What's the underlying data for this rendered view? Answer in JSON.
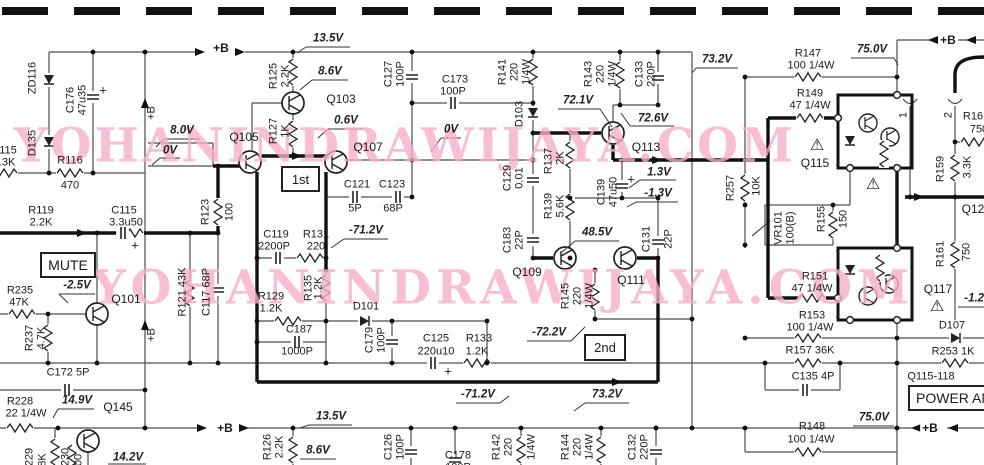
{
  "watermark": {
    "text": "YOHANINDRAWIJAYA.COM"
  },
  "boxes": {
    "mute": "MUTE",
    "stage1": "1st",
    "stage2": "2nd",
    "power_amp": "POWER AMP"
  },
  "colors": {
    "wire": "#4d4d4d",
    "bus": "#111111",
    "watermark_pink": "#f7aec9",
    "background": "#ffffff"
  },
  "labels": [
    {
      "t": "115",
      "x": 8,
      "y": 151
    },
    {
      "t": "3.3K",
      "x": 4,
      "y": 163
    },
    {
      "t": "ZD116",
      "x": 33,
      "y": 78,
      "v": 1
    },
    {
      "t": "D135",
      "x": 33,
      "y": 143,
      "v": 1
    },
    {
      "t": "C176",
      "x": 71,
      "y": 100,
      "v": 1
    },
    {
      "t": "47u35",
      "x": 83,
      "y": 100,
      "v": 1
    },
    {
      "t": "+",
      "x": 103,
      "y": 90,
      "s": 13
    },
    {
      "t": "R116",
      "x": 70,
      "y": 161
    },
    {
      "t": "470",
      "x": 70,
      "y": 186
    },
    {
      "t": "R119",
      "x": 41,
      "y": 211
    },
    {
      "t": "2.2K",
      "x": 41,
      "y": 223
    },
    {
      "t": "C115",
      "x": 124,
      "y": 211
    },
    {
      "t": "3.3u50",
      "x": 126,
      "y": 223
    },
    {
      "t": "+",
      "x": 135,
      "y": 245,
      "s": 13
    },
    {
      "t": "-2.5V",
      "x": 77,
      "y": 286,
      "i": 1
    },
    {
      "t": "Q101",
      "x": 126,
      "y": 299,
      "s": 12
    },
    {
      "t": "R235",
      "x": 20,
      "y": 291
    },
    {
      "t": "47K",
      "x": 19,
      "y": 303
    },
    {
      "t": "R237",
      "x": 30,
      "y": 338,
      "v": 1
    },
    {
      "t": "4.7K",
      "x": 42,
      "y": 338,
      "v": 1
    },
    {
      "t": "C172 5P",
      "x": 68,
      "y": 373
    },
    {
      "t": "R228",
      "x": 20,
      "y": 402
    },
    {
      "t": "22 1/4W",
      "x": 26,
      "y": 414
    },
    {
      "t": "14.9V",
      "x": 77,
      "y": 401,
      "i": 1
    },
    {
      "t": "Q145",
      "x": 118,
      "y": 407,
      "s": 12
    },
    {
      "t": "229",
      "x": 30,
      "y": 457,
      "v": 1
    },
    {
      "t": "8K",
      "x": 43,
      "y": 460,
      "v": 1
    },
    {
      "t": "230",
      "x": 66,
      "y": 457,
      "v": 1
    },
    {
      "t": "00",
      "x": 79,
      "y": 460,
      "v": 1
    },
    {
      "t": "14.2V",
      "x": 128,
      "y": 458,
      "i": 1
    },
    {
      "t": "+B",
      "x": 152,
      "y": 113,
      "v": 1
    },
    {
      "t": "+B",
      "x": 152,
      "y": 335,
      "v": 1
    },
    {
      "t": "+B",
      "x": 221,
      "y": 48,
      "bg": 1
    },
    {
      "t": "+B",
      "x": 225,
      "y": 428,
      "bg": 1
    },
    {
      "t": "13.5V",
      "x": 328,
      "y": 39,
      "i": 1
    },
    {
      "t": "R125",
      "x": 274,
      "y": 76,
      "v": 1
    },
    {
      "t": "2.2K",
      "x": 286,
      "y": 76,
      "v": 1
    },
    {
      "t": "8.6V",
      "x": 330,
      "y": 72,
      "i": 1
    },
    {
      "t": "Q103",
      "x": 341,
      "y": 99,
      "s": 12
    },
    {
      "t": "R127",
      "x": 274,
      "y": 131,
      "v": 1
    },
    {
      "t": "1K",
      "x": 286,
      "y": 131,
      "v": 1
    },
    {
      "t": "0.6V",
      "x": 346,
      "y": 121,
      "i": 1
    },
    {
      "t": "8.0V",
      "x": 182,
      "y": 131,
      "i": 1
    },
    {
      "t": "0V",
      "x": 170,
      "y": 151,
      "i": 1
    },
    {
      "t": "Q105",
      "x": 244,
      "y": 137,
      "s": 12
    },
    {
      "t": "R123",
      "x": 206,
      "y": 212,
      "v": 1
    },
    {
      "t": "100",
      "x": 230,
      "y": 212,
      "v": 1
    },
    {
      "t": "C119",
      "x": 276,
      "y": 235
    },
    {
      "t": "2200P",
      "x": 274,
      "y": 247
    },
    {
      "t": "R131",
      "x": 316,
      "y": 235
    },
    {
      "t": "220",
      "x": 316,
      "y": 247
    },
    {
      "t": "C121",
      "x": 357,
      "y": 185
    },
    {
      "t": "5P",
      "x": 355,
      "y": 209
    },
    {
      "t": "C123",
      "x": 392,
      "y": 185
    },
    {
      "t": "68P",
      "x": 393,
      "y": 209
    },
    {
      "t": "-71.2V",
      "x": 366,
      "y": 231,
      "i": 1
    },
    {
      "t": "Q107",
      "x": 368,
      "y": 147,
      "s": 12
    },
    {
      "t": "C127",
      "x": 389,
      "y": 74,
      "v": 1
    },
    {
      "t": "100P",
      "x": 401,
      "y": 74,
      "v": 1
    },
    {
      "t": "C173",
      "x": 455,
      "y": 80
    },
    {
      "t": "100P",
      "x": 453,
      "y": 92
    },
    {
      "t": "0V",
      "x": 451,
      "y": 130,
      "i": 1
    },
    {
      "t": "R141",
      "x": 503,
      "y": 72,
      "v": 1
    },
    {
      "t": "220",
      "x": 515,
      "y": 72,
      "v": 1
    },
    {
      "t": "1/4W",
      "x": 527,
      "y": 72,
      "v": 1
    },
    {
      "t": "D103",
      "x": 520,
      "y": 114,
      "v": 1
    },
    {
      "t": "72.1V",
      "x": 578,
      "y": 101,
      "i": 1
    },
    {
      "t": "R143",
      "x": 589,
      "y": 74,
      "v": 1
    },
    {
      "t": "220",
      "x": 601,
      "y": 74,
      "v": 1
    },
    {
      "t": "1/4W",
      "x": 613,
      "y": 74,
      "v": 1
    },
    {
      "t": "C133",
      "x": 640,
      "y": 74,
      "v": 1
    },
    {
      "t": "220P",
      "x": 652,
      "y": 74,
      "v": 1
    },
    {
      "t": "72.6V",
      "x": 653,
      "y": 119,
      "i": 1
    },
    {
      "t": "Q113",
      "x": 646,
      "y": 147,
      "s": 12
    },
    {
      "t": "73.2V",
      "x": 717,
      "y": 60,
      "i": 1
    },
    {
      "t": "C129",
      "x": 508,
      "y": 178,
      "v": 1
    },
    {
      "t": "0.01",
      "x": 520,
      "y": 178,
      "v": 1
    },
    {
      "t": "C183",
      "x": 508,
      "y": 240,
      "v": 1
    },
    {
      "t": "22P",
      "x": 520,
      "y": 240,
      "v": 1
    },
    {
      "t": "R137",
      "x": 549,
      "y": 161,
      "v": 1
    },
    {
      "t": "2K",
      "x": 561,
      "y": 158,
      "v": 1
    },
    {
      "t": "R139",
      "x": 549,
      "y": 206,
      "v": 1
    },
    {
      "t": "5.6K",
      "x": 561,
      "y": 206,
      "v": 1
    },
    {
      "t": "C139",
      "x": 602,
      "y": 192,
      "v": 1
    },
    {
      "t": "47u50",
      "x": 614,
      "y": 192,
      "v": 1
    },
    {
      "t": "+",
      "x": 631,
      "y": 179,
      "s": 13
    },
    {
      "t": "1.3V",
      "x": 659,
      "y": 173,
      "i": 1
    },
    {
      "t": "-1.3V",
      "x": 658,
      "y": 194,
      "i": 1
    },
    {
      "t": "48.5V",
      "x": 597,
      "y": 233,
      "i": 1
    },
    {
      "t": "C131",
      "x": 647,
      "y": 239,
      "v": 1
    },
    {
      "t": "22P",
      "x": 669,
      "y": 239,
      "v": 1
    },
    {
      "t": "Q109",
      "x": 527,
      "y": 272,
      "s": 12
    },
    {
      "t": "Q111",
      "x": 631,
      "y": 280,
      "s": 12
    },
    {
      "t": "R145",
      "x": 566,
      "y": 296,
      "v": 1
    },
    {
      "t": "220",
      "x": 578,
      "y": 296,
      "v": 1
    },
    {
      "t": "1/4W",
      "x": 590,
      "y": 296,
      "v": 1
    },
    {
      "t": "-72.2V",
      "x": 549,
      "y": 333,
      "i": 1
    },
    {
      "t": "R121 43K",
      "x": 183,
      "y": 292,
      "v": 1
    },
    {
      "t": "C117 68P",
      "x": 207,
      "y": 292,
      "v": 1
    },
    {
      "t": "R129",
      "x": 271,
      "y": 297
    },
    {
      "t": "1.2K",
      "x": 271,
      "y": 309
    },
    {
      "t": "R135",
      "x": 309,
      "y": 288,
      "v": 1
    },
    {
      "t": "1.2K",
      "x": 319,
      "y": 288,
      "v": 1
    },
    {
      "t": "D101",
      "x": 366,
      "y": 307
    },
    {
      "t": "C187",
      "x": 299,
      "y": 330
    },
    {
      "t": "1000P",
      "x": 297,
      "y": 352
    },
    {
      "t": "C179",
      "x": 370,
      "y": 340,
      "v": 1
    },
    {
      "t": "100P",
      "x": 382,
      "y": 340,
      "v": 1
    },
    {
      "t": "C125",
      "x": 436,
      "y": 339
    },
    {
      "t": "220u10",
      "x": 436,
      "y": 352
    },
    {
      "t": "R133",
      "x": 479,
      "y": 339
    },
    {
      "t": "1.2K",
      "x": 477,
      "y": 352
    },
    {
      "t": "+",
      "x": 448,
      "y": 371,
      "s": 13
    },
    {
      "t": "-71.2V",
      "x": 478,
      "y": 395,
      "i": 1
    },
    {
      "t": "73.2V",
      "x": 607,
      "y": 395,
      "i": 1
    },
    {
      "t": "13.5V",
      "x": 331,
      "y": 417,
      "i": 1
    },
    {
      "t": "R126",
      "x": 268,
      "y": 447,
      "v": 1
    },
    {
      "t": "2.2K",
      "x": 280,
      "y": 447,
      "v": 1
    },
    {
      "t": "8.6V",
      "x": 318,
      "y": 451,
      "i": 1
    },
    {
      "t": "C126",
      "x": 389,
      "y": 447,
      "v": 1
    },
    {
      "t": "100P",
      "x": 401,
      "y": 447,
      "v": 1
    },
    {
      "t": "C178",
      "x": 458,
      "y": 456
    },
    {
      "t": "100P",
      "x": 458,
      "y": 468
    },
    {
      "t": "R142",
      "x": 497,
      "y": 447,
      "v": 1
    },
    {
      "t": "220",
      "x": 509,
      "y": 447,
      "v": 1
    },
    {
      "t": "1/4W",
      "x": 532,
      "y": 447,
      "v": 1
    },
    {
      "t": "R144",
      "x": 566,
      "y": 447,
      "v": 1
    },
    {
      "t": "220",
      "x": 578,
      "y": 447,
      "v": 1
    },
    {
      "t": "1/4W",
      "x": 590,
      "y": 447,
      "v": 1
    },
    {
      "t": "C132",
      "x": 633,
      "y": 447,
      "v": 1
    },
    {
      "t": "220P",
      "x": 645,
      "y": 447,
      "v": 1
    },
    {
      "t": "R147",
      "x": 808,
      "y": 54
    },
    {
      "t": "100 1/4W",
      "x": 811,
      "y": 66
    },
    {
      "t": "75.0V",
      "x": 872,
      "y": 50,
      "i": 1
    },
    {
      "t": "+B",
      "x": 948,
      "y": 40,
      "bg": 1
    },
    {
      "t": "R149",
      "x": 810,
      "y": 94
    },
    {
      "t": "47 1/4W",
      "x": 810,
      "y": 106
    },
    {
      "t": "⚠",
      "x": 817,
      "y": 146,
      "s": 16
    },
    {
      "t": "Q115",
      "x": 815,
      "y": 163,
      "s": 12
    },
    {
      "t": "⚠",
      "x": 873,
      "y": 185,
      "s": 16
    },
    {
      "t": "R257",
      "x": 731,
      "y": 188,
      "v": 1
    },
    {
      "t": "10K",
      "x": 757,
      "y": 186,
      "v": 1
    },
    {
      "t": "VR101",
      "x": 779,
      "y": 228,
      "v": 1
    },
    {
      "t": "100(B)",
      "x": 791,
      "y": 228,
      "v": 1
    },
    {
      "t": "R155",
      "x": 822,
      "y": 219,
      "v": 1
    },
    {
      "t": "150",
      "x": 844,
      "y": 219,
      "v": 1
    },
    {
      "t": "R151",
      "x": 815,
      "y": 277
    },
    {
      "t": "47 1/4W",
      "x": 812,
      "y": 289
    },
    {
      "t": "Q117",
      "x": 938,
      "y": 289,
      "s": 12
    },
    {
      "t": "⚠",
      "x": 937,
      "y": 307,
      "s": 16
    },
    {
      "t": "-1.2V",
      "x": 978,
      "y": 299,
      "i": 1
    },
    {
      "t": "R153",
      "x": 812,
      "y": 316
    },
    {
      "t": "100 1/4W",
      "x": 810,
      "y": 328
    },
    {
      "t": "D107",
      "x": 952,
      "y": 326
    },
    {
      "t": "R157 36K",
      "x": 810,
      "y": 351
    },
    {
      "t": "R253 1K",
      "x": 953,
      "y": 352
    },
    {
      "t": "C135 4P",
      "x": 813,
      "y": 377
    },
    {
      "t": "Q115-118",
      "x": 931,
      "y": 377
    },
    {
      "t": "R148",
      "x": 812,
      "y": 427
    },
    {
      "t": "100 1/4W",
      "x": 811,
      "y": 440
    },
    {
      "t": "75.0V",
      "x": 874,
      "y": 418,
      "i": 1
    },
    {
      "t": "+B",
      "x": 930,
      "y": 428,
      "bg": 1
    },
    {
      "t": "R159",
      "x": 941,
      "y": 169,
      "v": 1
    },
    {
      "t": "3.3K",
      "x": 968,
      "y": 167,
      "v": 1
    },
    {
      "t": "R161",
      "x": 941,
      "y": 254,
      "v": 1
    },
    {
      "t": "750",
      "x": 967,
      "y": 252,
      "v": 1
    },
    {
      "t": "R16",
      "x": 973,
      "y": 117
    },
    {
      "t": "750",
      "x": 979,
      "y": 130
    },
    {
      "t": "Q12",
      "x": 973,
      "y": 209,
      "s": 12
    },
    {
      "t": "1",
      "x": 904,
      "y": 115,
      "v": 1
    },
    {
      "t": "2",
      "x": 949,
      "y": 115,
      "v": 1
    }
  ]
}
